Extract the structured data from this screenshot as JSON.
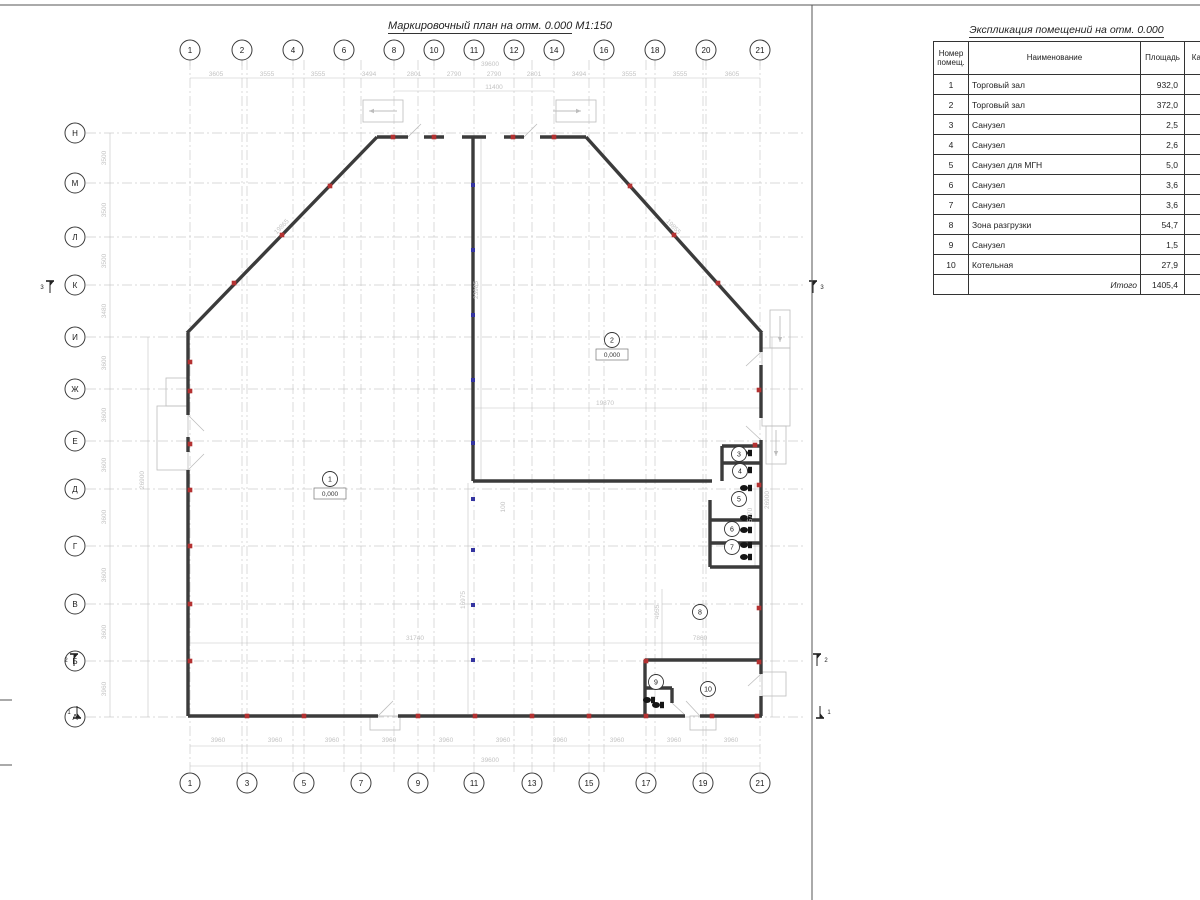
{
  "plan_title": "Маркировочный план на отм. 0.000",
  "plan_scale": " М1:150",
  "table": {
    "title": "Экспликация помещений на отм. 0.000",
    "headers": [
      "Номер помещ.",
      "Наименование",
      "Площадь",
      "Кат. пом"
    ],
    "rows": [
      [
        "1",
        "Торговый зал",
        "932,0"
      ],
      [
        "2",
        "Торговый зал",
        "372,0"
      ],
      [
        "3",
        "Санузел",
        "2,5"
      ],
      [
        "4",
        "Санузел",
        "2,6"
      ],
      [
        "5",
        "Санузел для МГН",
        "5,0"
      ],
      [
        "6",
        "Санузел",
        "3,6"
      ],
      [
        "7",
        "Санузел",
        "3,6"
      ],
      [
        "8",
        "Зона разгрузки",
        "54,7"
      ],
      [
        "9",
        "Санузел",
        "1,5"
      ],
      [
        "10",
        "Котельная",
        "27,9"
      ]
    ],
    "total_label": "Итого",
    "total_value": "1405,4"
  },
  "colors": {
    "wall": "#3b3b3b",
    "grid": "#cccccc",
    "dim": "#c3c3c3",
    "thin": "#bdbdbd",
    "red": "#b43232",
    "blue": "#3434a0",
    "frame": "#555555"
  },
  "plan": {
    "axes": {
      "top": [
        [
          "1",
          190
        ],
        [
          "2",
          242
        ],
        [
          "4",
          293
        ],
        [
          "6",
          344
        ],
        [
          "8",
          394
        ],
        [
          "10",
          434
        ],
        [
          "11",
          474
        ],
        [
          "12",
          514
        ],
        [
          "14",
          554
        ],
        [
          "16",
          604
        ],
        [
          "18",
          655
        ],
        [
          "20",
          706
        ],
        [
          "21",
          760
        ]
      ],
      "bottom": [
        [
          "1",
          190
        ],
        [
          "3",
          247
        ],
        [
          "5",
          304
        ],
        [
          "7",
          361
        ],
        [
          "9",
          418
        ],
        [
          "11",
          474
        ],
        [
          "13",
          532
        ],
        [
          "15",
          589
        ],
        [
          "17",
          646
        ],
        [
          "19",
          703
        ],
        [
          "21",
          760
        ]
      ],
      "left": [
        [
          "Н",
          133
        ],
        [
          "М",
          183
        ],
        [
          "Л",
          237
        ],
        [
          "К",
          285
        ],
        [
          "И",
          337
        ],
        [
          "Ж",
          389
        ],
        [
          "Е",
          441
        ],
        [
          "Д",
          489
        ],
        [
          "Г",
          546
        ],
        [
          "В",
          604
        ],
        [
          "Б",
          661
        ],
        [
          "А",
          717
        ]
      ]
    },
    "grid_x": [
      190,
      242,
      247,
      293,
      304,
      344,
      361,
      394,
      418,
      434,
      474,
      514,
      532,
      554,
      589,
      604,
      646,
      655,
      703,
      706,
      760
    ],
    "walls": [
      [
        377,
        137,
        408,
        137
      ],
      [
        424,
        137,
        444,
        137
      ],
      [
        462,
        137,
        486,
        137
      ],
      [
        504,
        137,
        524,
        137
      ],
      [
        540,
        137,
        586,
        137
      ],
      [
        473,
        137,
        473,
        481
      ],
      [
        473,
        481,
        712,
        481
      ],
      [
        377,
        137,
        187,
        333
      ],
      [
        586,
        137,
        762,
        333
      ],
      [
        188,
        333,
        188,
        415
      ],
      [
        188,
        437,
        188,
        452
      ],
      [
        188,
        470,
        188,
        716
      ],
      [
        761,
        333,
        761,
        352
      ],
      [
        761,
        365,
        761,
        418
      ],
      [
        761,
        440,
        761,
        674
      ],
      [
        761,
        696,
        761,
        716
      ],
      [
        188,
        716,
        378,
        716
      ],
      [
        398,
        716,
        685,
        716
      ],
      [
        700,
        716,
        762,
        716
      ],
      [
        645,
        660,
        762,
        660
      ],
      [
        645,
        660,
        645,
        716
      ],
      [
        645,
        688,
        672,
        688
      ],
      [
        672,
        688,
        672,
        703
      ],
      [
        722,
        446,
        761,
        446
      ],
      [
        722,
        463,
        761,
        463
      ],
      [
        722,
        446,
        722,
        481
      ],
      [
        710,
        520,
        761,
        520
      ],
      [
        710,
        543,
        761,
        543
      ],
      [
        710,
        567,
        761,
        567
      ],
      [
        710,
        500,
        710,
        567
      ]
    ],
    "door_swings": [
      [
        188,
        415,
        204,
        431
      ],
      [
        188,
        470,
        204,
        454
      ],
      [
        761,
        352,
        746,
        366
      ],
      [
        761,
        440,
        746,
        426
      ],
      [
        378,
        716,
        393,
        701
      ],
      [
        700,
        716,
        686,
        701
      ],
      [
        672,
        703,
        684,
        714
      ],
      [
        761,
        674,
        748,
        686
      ],
      [
        408,
        137,
        421,
        124
      ],
      [
        524,
        137,
        537,
        124
      ]
    ],
    "thin_rects": [
      [
        363,
        100,
        40,
        22
      ],
      [
        556,
        100,
        40,
        22
      ],
      [
        157,
        406,
        31,
        64
      ],
      [
        166,
        378,
        22,
        28
      ],
      [
        762,
        348,
        28,
        78
      ],
      [
        770,
        310,
        20,
        38
      ],
      [
        766,
        426,
        20,
        38
      ],
      [
        370,
        716,
        30,
        14
      ],
      [
        690,
        716,
        26,
        14
      ],
      [
        762,
        672,
        24,
        24
      ]
    ],
    "arrows": [
      [
        397,
        111,
        369,
        111
      ],
      [
        553,
        111,
        581,
        111
      ],
      [
        780,
        316,
        780,
        342
      ],
      [
        776,
        430,
        776,
        456
      ]
    ],
    "dim_lines": [
      [
        190,
        78,
        760,
        78
      ],
      [
        394,
        91,
        554,
        91
      ],
      [
        190,
        746,
        760,
        746
      ],
      [
        190,
        766,
        760,
        766
      ],
      [
        110,
        133,
        110,
        717
      ],
      [
        148,
        337,
        148,
        717
      ],
      [
        772,
        337,
        772,
        717
      ],
      [
        190,
        643,
        759,
        643
      ],
      [
        475,
        408,
        760,
        408
      ],
      [
        481,
        139,
        481,
        479
      ],
      [
        468,
        483,
        468,
        714
      ],
      [
        662,
        589,
        662,
        660
      ],
      [
        755,
        483,
        755,
        566
      ]
    ],
    "dims": [
      {
        "t": "3605",
        "x": 216,
        "y": 76,
        "r": 0
      },
      {
        "t": "3555",
        "x": 267,
        "y": 76,
        "r": 0
      },
      {
        "t": "3555",
        "x": 318,
        "y": 76,
        "r": 0
      },
      {
        "t": "3494",
        "x": 369,
        "y": 76,
        "r": 0
      },
      {
        "t": "2801",
        "x": 414,
        "y": 76,
        "r": 0
      },
      {
        "t": "2790",
        "x": 454,
        "y": 76,
        "r": 0
      },
      {
        "t": "2790",
        "x": 494,
        "y": 76,
        "r": 0
      },
      {
        "t": "2801",
        "x": 534,
        "y": 76,
        "r": 0
      },
      {
        "t": "3494",
        "x": 579,
        "y": 76,
        "r": 0
      },
      {
        "t": "3555",
        "x": 629,
        "y": 76,
        "r": 0
      },
      {
        "t": "3555",
        "x": 680,
        "y": 76,
        "r": 0
      },
      {
        "t": "3605",
        "x": 732,
        "y": 76,
        "r": 0
      },
      {
        "t": "39600",
        "x": 490,
        "y": 66,
        "r": 0
      },
      {
        "t": "11400",
        "x": 494,
        "y": 89,
        "r": 0
      },
      {
        "t": "3960",
        "x": 218,
        "y": 742,
        "r": 0
      },
      {
        "t": "3960",
        "x": 275,
        "y": 742,
        "r": 0
      },
      {
        "t": "3960",
        "x": 332,
        "y": 742,
        "r": 0
      },
      {
        "t": "3960",
        "x": 389,
        "y": 742,
        "r": 0
      },
      {
        "t": "3960",
        "x": 446,
        "y": 742,
        "r": 0
      },
      {
        "t": "3960",
        "x": 503,
        "y": 742,
        "r": 0
      },
      {
        "t": "3960",
        "x": 560,
        "y": 742,
        "r": 0
      },
      {
        "t": "3960",
        "x": 617,
        "y": 742,
        "r": 0
      },
      {
        "t": "3960",
        "x": 674,
        "y": 742,
        "r": 0
      },
      {
        "t": "3960",
        "x": 731,
        "y": 742,
        "r": 0
      },
      {
        "t": "39600",
        "x": 490,
        "y": 762,
        "r": 0
      },
      {
        "t": "3500",
        "x": 106,
        "y": 158,
        "r": -90
      },
      {
        "t": "3500",
        "x": 106,
        "y": 210,
        "r": -90
      },
      {
        "t": "3500",
        "x": 106,
        "y": 261,
        "r": -90
      },
      {
        "t": "3480",
        "x": 106,
        "y": 311,
        "r": -90
      },
      {
        "t": "3600",
        "x": 106,
        "y": 363,
        "r": -90
      },
      {
        "t": "3600",
        "x": 106,
        "y": 415,
        "r": -90
      },
      {
        "t": "3600",
        "x": 106,
        "y": 465,
        "r": -90
      },
      {
        "t": "3600",
        "x": 106,
        "y": 517,
        "r": -90
      },
      {
        "t": "3600",
        "x": 106,
        "y": 575,
        "r": -90
      },
      {
        "t": "3600",
        "x": 106,
        "y": 632,
        "r": -90
      },
      {
        "t": "3960",
        "x": 106,
        "y": 689,
        "r": -90
      },
      {
        "t": "26900",
        "x": 144,
        "y": 480,
        "r": -90
      },
      {
        "t": "26900",
        "x": 769,
        "y": 500,
        "r": -90
      },
      {
        "t": "31740",
        "x": 415,
        "y": 640,
        "r": 0
      },
      {
        "t": "7860",
        "x": 700,
        "y": 640,
        "r": 0
      },
      {
        "t": "19870",
        "x": 605,
        "y": 405,
        "r": 0
      },
      {
        "t": "23985",
        "x": 478,
        "y": 290,
        "r": -90
      },
      {
        "t": "16975",
        "x": 465,
        "y": 600,
        "r": -90
      },
      {
        "t": "4955",
        "x": 659,
        "y": 612,
        "r": -90
      },
      {
        "t": "5770",
        "x": 752,
        "y": 515,
        "r": -90
      },
      {
        "t": "100",
        "x": 505,
        "y": 507,
        "r": -90
      },
      {
        "t": "19865",
        "x": 283,
        "y": 228,
        "r": -46
      },
      {
        "t": "19855",
        "x": 672,
        "y": 228,
        "r": 46
      }
    ],
    "red_markers": [
      [
        393,
        137
      ],
      [
        434,
        137
      ],
      [
        513,
        137
      ],
      [
        554,
        137
      ],
      [
        234,
        283
      ],
      [
        282,
        235
      ],
      [
        330,
        186
      ],
      [
        630,
        186
      ],
      [
        674,
        235
      ],
      [
        718,
        283
      ],
      [
        190,
        362
      ],
      [
        190,
        391
      ],
      [
        190,
        444
      ],
      [
        190,
        490
      ],
      [
        190,
        546
      ],
      [
        190,
        604
      ],
      [
        190,
        661
      ],
      [
        247,
        716
      ],
      [
        304,
        716
      ],
      [
        418,
        716
      ],
      [
        475,
        716
      ],
      [
        532,
        716
      ],
      [
        589,
        716
      ],
      [
        646,
        716
      ],
      [
        712,
        716
      ],
      [
        757,
        716
      ],
      [
        759,
        390
      ],
      [
        759,
        485
      ],
      [
        759,
        608
      ],
      [
        759,
        662
      ],
      [
        755,
        445
      ],
      [
        646,
        661
      ]
    ],
    "blue_markers": [
      [
        473,
        185
      ],
      [
        473,
        250
      ],
      [
        473,
        315
      ],
      [
        473,
        380
      ],
      [
        473,
        443
      ],
      [
        473,
        499
      ],
      [
        473,
        550
      ],
      [
        473,
        605
      ],
      [
        473,
        660
      ]
    ],
    "fixtures": [
      [
        749,
        453
      ],
      [
        749,
        470
      ],
      [
        749,
        488
      ],
      [
        749,
        518
      ],
      [
        749,
        530
      ],
      [
        749,
        545
      ],
      [
        749,
        557
      ],
      [
        652,
        700
      ],
      [
        661,
        705
      ]
    ],
    "rooms": [
      {
        "num": "1",
        "x": 330,
        "y": 479,
        "level": "0,000"
      },
      {
        "num": "2",
        "x": 612,
        "y": 340,
        "level": "0,000"
      },
      {
        "num": "3",
        "x": 739,
        "y": 454
      },
      {
        "num": "4",
        "x": 740,
        "y": 471
      },
      {
        "num": "5",
        "x": 739,
        "y": 499
      },
      {
        "num": "6",
        "x": 732,
        "y": 529
      },
      {
        "num": "7",
        "x": 732,
        "y": 547
      },
      {
        "num": "8",
        "x": 700,
        "y": 612
      },
      {
        "num": "9",
        "x": 656,
        "y": 682
      },
      {
        "num": "10",
        "x": 708,
        "y": 689
      }
    ],
    "sections": [
      {
        "l": "3",
        "x": 50,
        "y": 287,
        "bar": "top"
      },
      {
        "l": "3",
        "x": 813,
        "y": 287,
        "bar": "top"
      },
      {
        "l": "2",
        "x": 74,
        "y": 660,
        "bar": "top"
      },
      {
        "l": "2",
        "x": 817,
        "y": 660,
        "bar": "top"
      },
      {
        "l": "1",
        "x": 77,
        "y": 712,
        "bar": "bottom"
      },
      {
        "l": "1",
        "x": 820,
        "y": 712,
        "bar": "bottom"
      }
    ],
    "frame_lines": [
      [
        0,
        5,
        1200,
        5
      ],
      [
        812,
        5,
        812,
        900
      ],
      [
        0,
        700,
        12,
        700
      ],
      [
        0,
        765,
        12,
        765
      ]
    ]
  }
}
